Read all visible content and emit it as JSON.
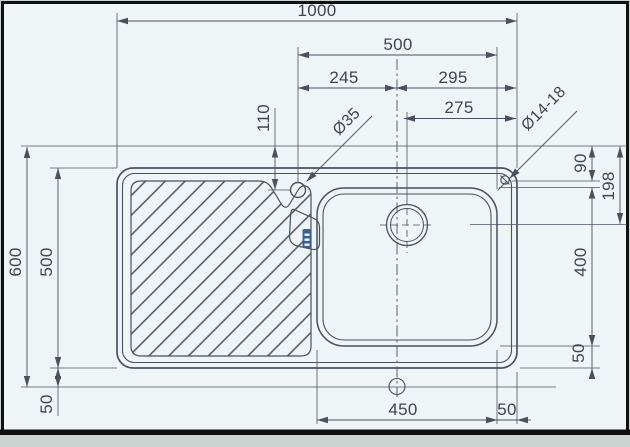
{
  "page": {
    "background": "#cdd3d0",
    "paper": "#eff4f6",
    "frame_color": "#101010"
  },
  "drawing": {
    "line_color": "#47525d",
    "text_color": "#3c4650",
    "brand_color": "#3c5f90",
    "dims": {
      "top": {
        "total_width": "1000",
        "tap_to_bowl_edge": "500",
        "tap_left": "245",
        "tap_right": "295",
        "drain_to_corner_hole": "275"
      },
      "left": {
        "total_depth": "600",
        "sink_depth": "500",
        "bottom_margin": "50"
      },
      "right": {
        "corner_hole_offset": "90",
        "drain_offset": "198",
        "bowl_depth": "400",
        "bowl_bottom_margin": "50"
      },
      "bottom": {
        "bowl_width": "450",
        "bowl_right_margin": "50"
      },
      "misc": {
        "tap_offset": "110",
        "tap_hole_diameter": "Ø35",
        "corner_hole_diameter": "Ø14-18"
      }
    }
  }
}
